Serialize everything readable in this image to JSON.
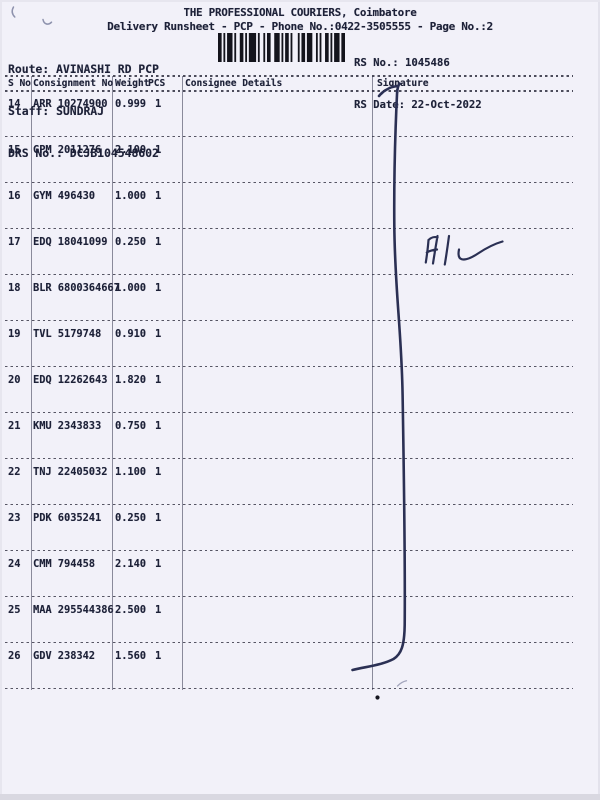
{
  "document": {
    "title": "THE PROFESSIONAL COURIERS, Coimbatore",
    "subtitle": "Delivery Runsheet - PCP - Phone No.:0422-3505555 - Page No.:2",
    "route_label": "Route:",
    "route_value": "AVINASHI RD PCP",
    "staff_label": "Staff:",
    "staff_value": "SUNDRAJ",
    "drs_label": "DRS No.:",
    "drs_value": "DCJB104548602",
    "rs_no_label": "RS No.:",
    "rs_no_value": "1045486",
    "rs_date_label": "RS Date:",
    "rs_date_value": "22-Oct-2022"
  },
  "table": {
    "columns": [
      "S No",
      "Consignment No",
      "Weight",
      "PCS",
      "Consignee Details",
      "Signature"
    ],
    "rows": [
      {
        "sno": "14",
        "consignment": "ARR 10274900",
        "weight": "0.999",
        "pcs": "1",
        "consignee": "",
        "signature": ""
      },
      {
        "sno": "15",
        "consignment": "GPM 2011276",
        "weight": "2.100",
        "pcs": "1",
        "consignee": "",
        "signature": ""
      },
      {
        "sno": "16",
        "consignment": "GYM 496430",
        "weight": "1.000",
        "pcs": "1",
        "consignee": "",
        "signature": ""
      },
      {
        "sno": "17",
        "consignment": "EDQ 18041099",
        "weight": "0.250",
        "pcs": "1",
        "consignee": "",
        "signature": ""
      },
      {
        "sno": "18",
        "consignment": "BLR 6800364667",
        "weight": "1.000",
        "pcs": "1",
        "consignee": "",
        "signature": ""
      },
      {
        "sno": "19",
        "consignment": "TVL 5179748",
        "weight": "0.910",
        "pcs": "1",
        "consignee": "",
        "signature": ""
      },
      {
        "sno": "20",
        "consignment": "EDQ 12262643",
        "weight": "1.820",
        "pcs": "1",
        "consignee": "",
        "signature": ""
      },
      {
        "sno": "21",
        "consignment": "KMU 2343833",
        "weight": "0.750",
        "pcs": "1",
        "consignee": "",
        "signature": ""
      },
      {
        "sno": "22",
        "consignment": "TNJ 22405032",
        "weight": "1.100",
        "pcs": "1",
        "consignee": "",
        "signature": ""
      },
      {
        "sno": "23",
        "consignment": "PDK 6035241",
        "weight": "0.250",
        "pcs": "1",
        "consignee": "",
        "signature": ""
      },
      {
        "sno": "24",
        "consignment": "CMM 794458",
        "weight": "2.140",
        "pcs": "1",
        "consignee": "",
        "signature": ""
      },
      {
        "sno": "25",
        "consignment": "MAA 295544386",
        "weight": "2.500",
        "pcs": "1",
        "consignee": "",
        "signature": ""
      },
      {
        "sno": "26",
        "consignment": "GDV 238342",
        "weight": "1.560",
        "pcs": "1",
        "consignee": "",
        "signature": ""
      }
    ]
  },
  "handwriting": {
    "mark_text": "HL",
    "ink_color": "#2b3054"
  },
  "colors": {
    "paper": "#f2f1f9",
    "text": "#1d2138",
    "line": "#45455c"
  }
}
